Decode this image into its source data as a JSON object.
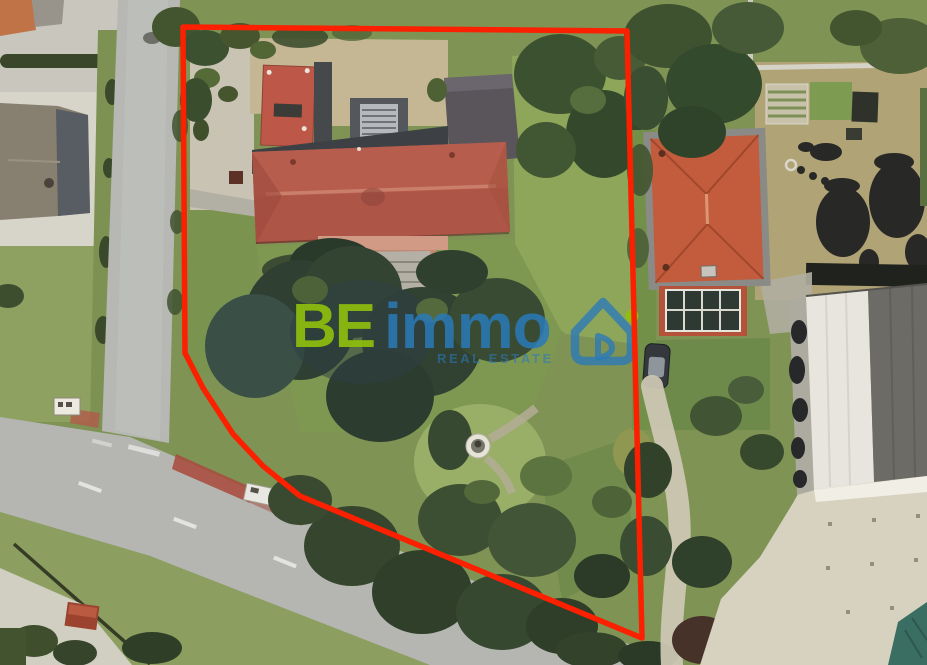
{
  "watermark": {
    "brand_first": "BE",
    "brand_second": "immo",
    "tagline": "REAL ESTATE",
    "color_green": "#8fbe0d",
    "color_blue": "#2a7ab9"
  },
  "boundary": {
    "color": "#fb2000",
    "stroke_width": "5.5",
    "points": "183,27 627,31 642,638 300,496 263,466 233,434 203,388 185,353"
  }
}
